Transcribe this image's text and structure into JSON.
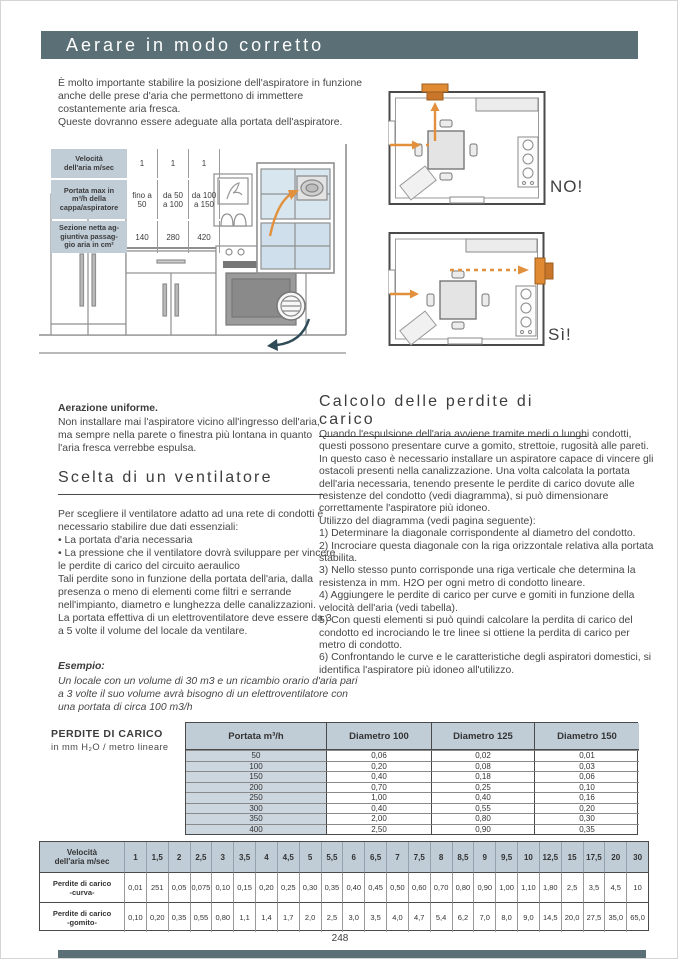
{
  "page": {
    "title": "Aerare in modo corretto",
    "number": "248"
  },
  "colors": {
    "header_bar": "#5a7076",
    "table_header": "#c0cdd7",
    "table_shade": "#ccd6de",
    "accent_orange": "#e2903c",
    "arrow_teal": "#2e4b57",
    "text": "#474747"
  },
  "intro": "È molto importante stabilire la posizione dell'aspiratore in funzione anche delle prese d'aria che permettono di immettere costantemente aria fresca.\nQueste dovranno essere adeguate alla portata dell'aspiratore.",
  "spec_table": {
    "rows": [
      {
        "label": "Velocità\ndell'aria m/sec",
        "values": [
          "1",
          "1",
          "1"
        ]
      },
      {
        "label": "Portata max in\nm³/h della\ncappa/aspiratore",
        "values": [
          "fino a\n50",
          "da 50\na 100",
          "da 100\na 150"
        ]
      },
      {
        "label": "Sezione netta ag-\ngiuntiva passag-\ngio aria in cm²",
        "values": [
          "140",
          "280",
          "420"
        ]
      }
    ]
  },
  "floorplans": {
    "no_label": "NO!",
    "yes_label": "Sì!"
  },
  "aerazione": {
    "title": "Aerazione uniforme.",
    "body": "Non installare mai l'aspiratore vicino all'ingresso dell'aria, ma sempre nella parete o finestra più lontana in quanto l'aria fresca verrebbe espulsa."
  },
  "scelta": {
    "title": "Scelta di un ventilatore",
    "body": "Per scegliere il ventilatore adatto ad una rete di condotti è necessario stabilire due dati essenziali:\n• La portata d'aria necessaria\n• La pressione che il ventilatore dovrà sviluppare per vincere le perdite di carico del circuito aeraulico\nTali perdite sono in funzione della portata dell'aria, dalla presenza o meno di elementi come filtri e serrande nell'impianto, diametro e lunghezza delle canalizzazioni.\nLa portata effettiva di un elettroventilatore deve essere da 3 a 5 volte il volume del locale da ventilare.",
    "esempio_title": "Esempio:",
    "esempio_body": "Un locale con un volume di 30 m3 e un ricambio orario d'aria pari a 3 volte il suo volume avrà bisogno di un elettroventilatore con una portata di circa 100 m3/h"
  },
  "calcolo": {
    "title": "Calcolo delle perdite di carico",
    "body": "Quando l'espulsione dell'aria avviene tramite medi o lunghi condotti, questi possono presentare curve a gomito, strettoie, rugosità alle pareti. In questo caso è necessario installare un aspiratore capace di vincere gli ostacoli presenti nella canalizzazione. Una volta calcolata la portata dell'aria necessaria, tenendo presente le perdite di carico dovute alle resistenze del condotto (vedi diagramma), si può dimensionare correttamente l'aspiratore più idoneo.\nUtilizzo del diagramma (vedi pagina seguente):\n1)  Determinare la diagonale corrispondente al diametro del condotto.\n2)  Incrociare questa diagonale con la riga orizzontale relativa alla portata stabilita.\n3)  Nello stesso punto corrisponde una riga verticale che determina la resistenza in mm. H2O per ogni metro di condotto lineare.\n4)  Aggiungere le perdite di carico per curve e gomiti in funzione della velocità dell'aria (vedi tabella).\n5)  Con questi elementi si può quindi calcolare la perdita di carico del condotto ed incrociando le tre linee si ottiene la perdita di carico per metro di condotto.\n6)  Confrontando le curve e le caratteristiche degli aspiratori domestici, si identifica l'aspiratore più idoneo all'utilizzo."
  },
  "perdite": {
    "caption_title": "PERDITE DI CARICO",
    "caption_sub": "in mm H₂O / metro lineare",
    "headers": [
      "Portata m³/h",
      "Diametro 100",
      "Diametro 125",
      "Diametro 150"
    ],
    "rows": [
      [
        "50",
        "0,06",
        "0,02",
        "0,01"
      ],
      [
        "100",
        "0,20",
        "0,08",
        "0,03"
      ],
      [
        "150",
        "0,40",
        "0,18",
        "0,06"
      ],
      [
        "200",
        "0,70",
        "0,25",
        "0,10"
      ],
      [
        "250",
        "1,00",
        "0,40",
        "0,16"
      ],
      [
        "300",
        "0,40",
        "0,55",
        "0,20"
      ],
      [
        "350",
        "2,00",
        "0,80",
        "0,30"
      ],
      [
        "400",
        "2,50",
        "0,90",
        "0,35"
      ]
    ]
  },
  "velocita": {
    "header_label": "Velocità\ndell'aria m/sec",
    "speeds": [
      "1",
      "1,5",
      "2",
      "2,5",
      "3",
      "3,5",
      "4",
      "4,5",
      "5",
      "5,5",
      "6",
      "6,5",
      "7",
      "7,5",
      "8",
      "8,5",
      "9",
      "9,5",
      "10",
      "12,5",
      "15",
      "17,5",
      "20",
      "30"
    ],
    "rows": [
      {
        "label": "Perdite di carico\n-curva-",
        "values": [
          "0,01",
          "251",
          "0,05",
          "0,075",
          "0,10",
          "0,15",
          "0,20",
          "0,25",
          "0,30",
          "0,35",
          "0,40",
          "0,45",
          "0,50",
          "0,60",
          "0,70",
          "0,80",
          "0,90",
          "1,00",
          "1,10",
          "1,80",
          "2,5",
          "3,5",
          "4,5",
          "10"
        ]
      },
      {
        "label": "Perdite di carico\n-gomito-",
        "values": [
          "0,10",
          "0,20",
          "0,35",
          "0,55",
          "0,80",
          "1,1",
          "1,4",
          "1,7",
          "2,0",
          "2,5",
          "3,0",
          "3,5",
          "4,0",
          "4,7",
          "5,4",
          "6,2",
          "7,0",
          "8,0",
          "9,0",
          "14,5",
          "20,0",
          "27,5",
          "35,0",
          "65,0"
        ]
      }
    ]
  }
}
